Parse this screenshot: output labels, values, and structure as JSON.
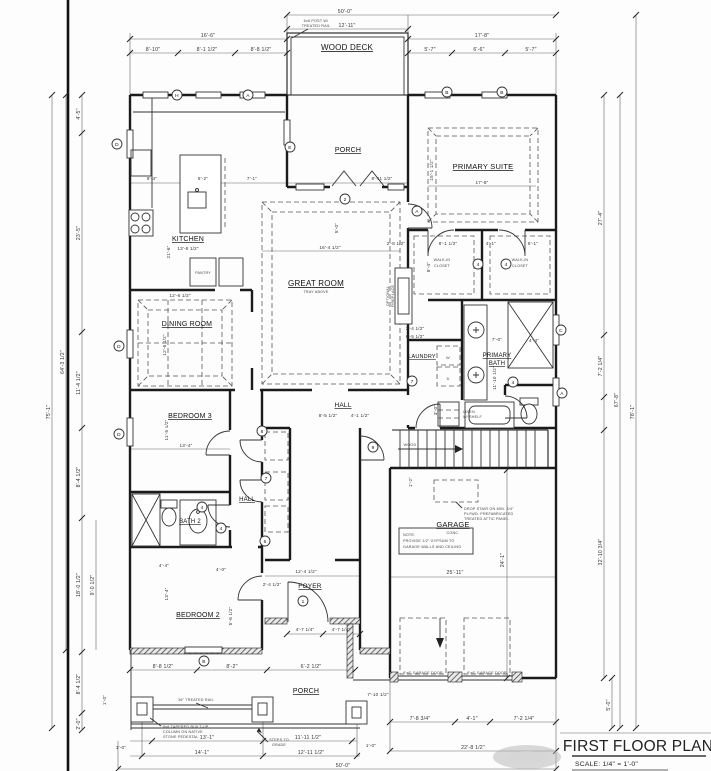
{
  "sheet": {
    "title": "FIRST FLOOR PLAN",
    "scale": "SCALE: 1/4\" = 1'-0\""
  },
  "rooms": {
    "wood_deck": "WOOD DECK",
    "porch_top": "PORCH",
    "primary_suite": "PRIMARY SUITE",
    "kitchen": "KITCHEN",
    "great_room": "GREAT ROOM",
    "great_room_sub": "TRAY ABOVE",
    "dining_room": "DINING ROOM",
    "bedroom3": "BEDROOM 3",
    "hall_upper": "HALL",
    "laundry": "LAUNDRY",
    "primary_bath_1": "PRIMARY",
    "primary_bath_2": "BATH",
    "bath2": "BATH 2",
    "hall_lower": "HALL",
    "bedroom2": "BEDROOM 2",
    "foyer": "FOYER",
    "garage": "GARAGE",
    "garage_sub": "CONC.",
    "porch_bottom": "PORCH",
    "wic_1": "WALK-IN",
    "wic_2": "CLOSET",
    "fireplace_1": "OPTIONAL",
    "fireplace_2": "FIREPLACE",
    "pantry": "PANTRY",
    "linen_1": "LINEN",
    "linen_2": "W/ SHELF",
    "washer": "W",
    "dryer": "D",
    "wood": "WOOD"
  },
  "dims": {
    "top": [
      "50'-0\"",
      "12'-11\"",
      "16'-6\"",
      "8'-10\"",
      "8'-1 1/2\"",
      "8'-8 1/2\"",
      "17'-8\"",
      "5'-7\"",
      "6'-6\"",
      "5'-7\""
    ],
    "left": [
      "75'-1\"",
      "64'-3 1/2\"",
      "4'-5\"",
      "23'-5\"",
      "11'-4 1/2\"",
      "8'-4 1/2\"",
      "18'-0 1/2\"",
      "8'-4 1/2\"",
      "2'-0\"",
      "9'-0 1/2\"",
      "1'-0\""
    ],
    "right": [
      "27'-4\"",
      "7'-2 1/4\"",
      "32'-10 3/4\"",
      "67'-8\"",
      "78'-1\"",
      "24'-1\"",
      "5'-0\""
    ],
    "bottom": [
      "8'-8 1/2\"",
      "8'-2\"",
      "6'-2 1/2\"",
      "13'-1\"",
      "11'-11 1/2\"",
      "14'-1\"",
      "12'-11 1/2\"",
      "50'-0\"",
      "1'-0\"",
      "1'-0\"",
      "7'-10 1/2\"",
      "7'-8 3/4\"",
      "4'-1\"",
      "7'-2 1/4\"",
      "22'-8 1/2\""
    ],
    "interior": [
      "8'-4\"",
      "8'-2\"",
      "7'-1\"",
      "8'-11 1/2\"",
      "21'-6\"",
      "5'-0\"",
      "13'-8 1/2\"",
      "16'-4 1/2\"",
      "12'-6 1/2\"",
      "12'-6 1/2\"",
      "13'-4\"",
      "11'-5 1/2\"",
      "17'-8\"",
      "15'-1 1/2\"",
      "2'-4 1/2\"",
      "6'-5 1/2\"",
      "7'-0\"",
      "11'-10 1/2\"",
      "4'-4\"",
      "25'-11\"",
      "8'-5 1/2\"",
      "4'-1 1/2\"",
      "12'-4 1/2\"",
      "2'-4 1/2\"",
      "4'-7 1/4\"",
      "4'-7 1/4\"",
      "13'-4\"",
      "5'-6 1/2\"",
      "4'-4\"",
      "4'-0\"",
      "3'-0\"",
      "1'-2\"",
      "2'-8 1/2\"",
      "8'-1 1/2\"",
      "4'-1\"",
      "8'-1\"",
      "8'-4\""
    ]
  },
  "tags": {
    "letters": [
      "H",
      "A",
      "B",
      "B",
      "E",
      "D",
      "D",
      "D",
      "C",
      "A",
      "B",
      "A"
    ],
    "numbers": [
      "1",
      "2",
      "4",
      "4",
      "4",
      "4",
      "6",
      "7",
      "7",
      "8",
      "9",
      "4"
    ]
  },
  "notes": {
    "deck_rail_1": "6x6 POST W/",
    "deck_rail_2": "TREATED RAIL",
    "porch_rail": "36\" TREATED RAIL",
    "column_1": "8x8 TAPERED BUILT-UP",
    "column_2": "COLUMN ON NATIVE",
    "column_3": "STONE PEDESTAL",
    "steps_1": "STEPS TO",
    "steps_2": "GRADE",
    "garage_note_title": "NOTE:",
    "garage_note_1": "PROVIDE 1/2\" GYPSUM TO",
    "garage_note_2": "GARAGE WALLS AND CEILING",
    "attic_1": "DROP STAIR ON MIN. 3/4\"",
    "attic_2": "PLYWD. PREFABRICATED",
    "attic_3": "TREATED ATTIC PANEL",
    "garage_door": "9'x8' GARAGE DOOR"
  }
}
